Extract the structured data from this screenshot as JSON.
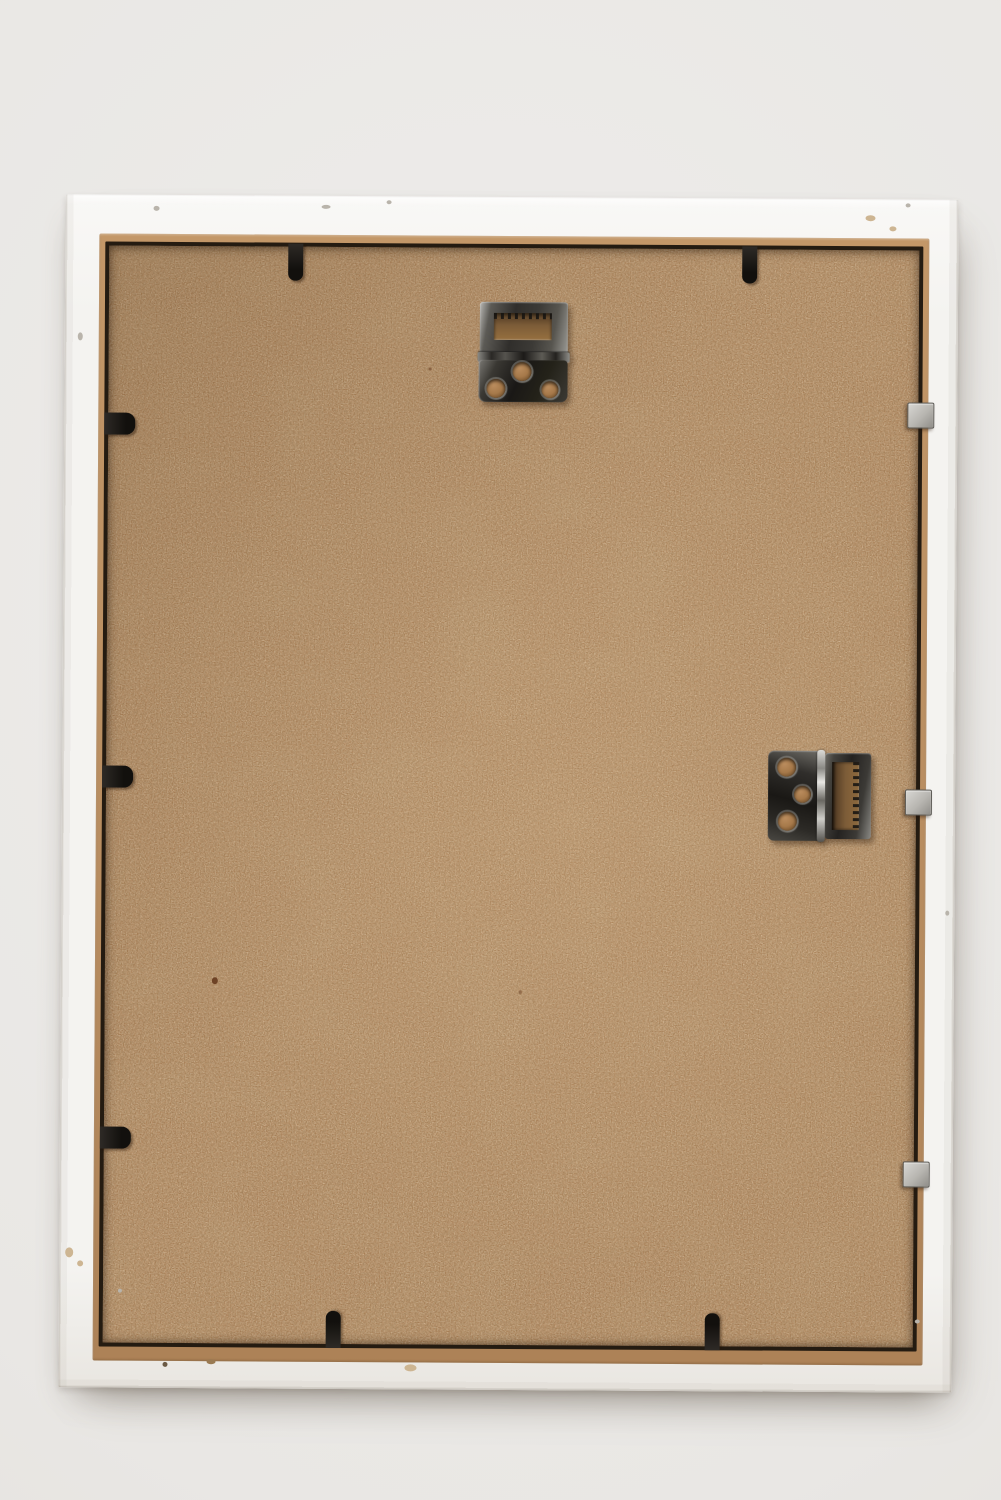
{
  "scene": {
    "type": "photograph",
    "subject": "Back of an empty white wooden picture frame",
    "elements": [
      "white painted wooden frame with chipped paint",
      "brown MDF hardboard backing panel",
      "tan rabbet lip around panel",
      "serrated-slot hinge hanger at top center",
      "serrated-slot hinge hanger rotated sideways at middle right",
      "black retainer clips on top, left and bottom edges",
      "silver metal point tabs on right edge"
    ],
    "hardware_counts": {
      "hinge_hangers": 2,
      "black_retainer_clips": 7,
      "silver_metal_tabs": 3,
      "screw_holes_per_hanger": 3
    }
  },
  "colors": {
    "bg": "#e9e7e4",
    "bg_light": "#eeedeb",
    "bg_dark": "#dfdcd7",
    "frame_white": "#f4f3f0",
    "frame_white_hi": "#f9f8f6",
    "frame_white_lo": "#e9e6e1",
    "rabbet_tan": "#ba8f62",
    "gap_dark": "#241b11",
    "board_brown": "#a87e55",
    "clip_black": "#12100d",
    "tab_silver": "#b7b5b0",
    "metal_gunmetal": "#2b2926"
  }
}
